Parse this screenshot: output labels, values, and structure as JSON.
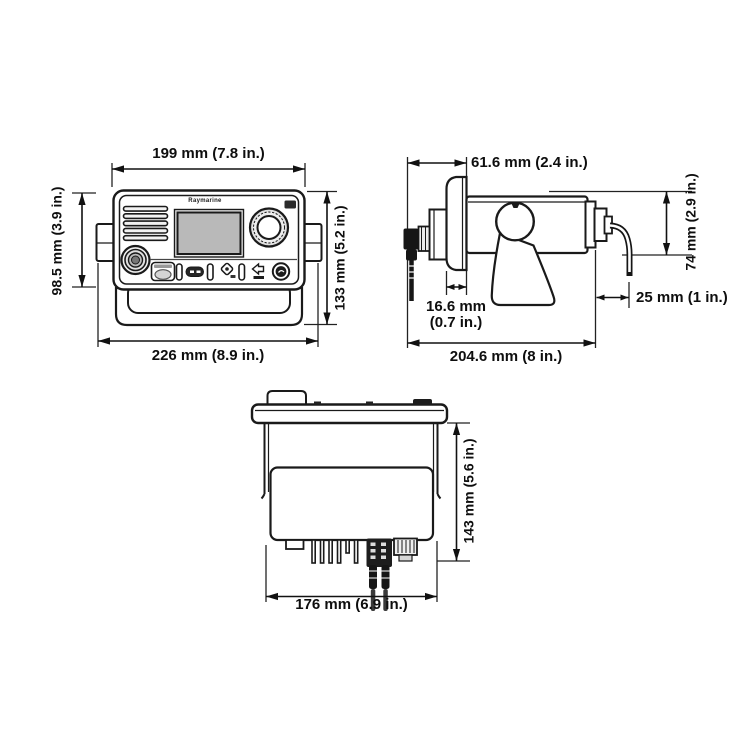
{
  "colors": {
    "line": "#1a1a1a",
    "dim_text": "#0e0e0e",
    "screen_fill": "#b9b9b9",
    "dark_fill": "#1c1c1c",
    "background": "#ffffff"
  },
  "front": {
    "brand": "Raymarine",
    "dims": {
      "top": "199 mm (7.8 in.)",
      "left": "98.5 mm (3.9 in.)",
      "right": "133 mm (5.2 in.)",
      "bottom": "226 mm (8.9 in.)"
    }
  },
  "side": {
    "dims": {
      "top": "61.6 mm (2.4 in.)",
      "right": "74 mm (2.9 in.)",
      "flange_line1": "16.6 mm",
      "flange_line2": "(0.7 in.)",
      "cable": "25 mm (1 in.)",
      "bottom": "204.6 mm (8 in.)"
    }
  },
  "rear": {
    "dims": {
      "right": "143 mm (5.6 in.)",
      "bottom": "176 mm (6.9 in.)"
    }
  }
}
